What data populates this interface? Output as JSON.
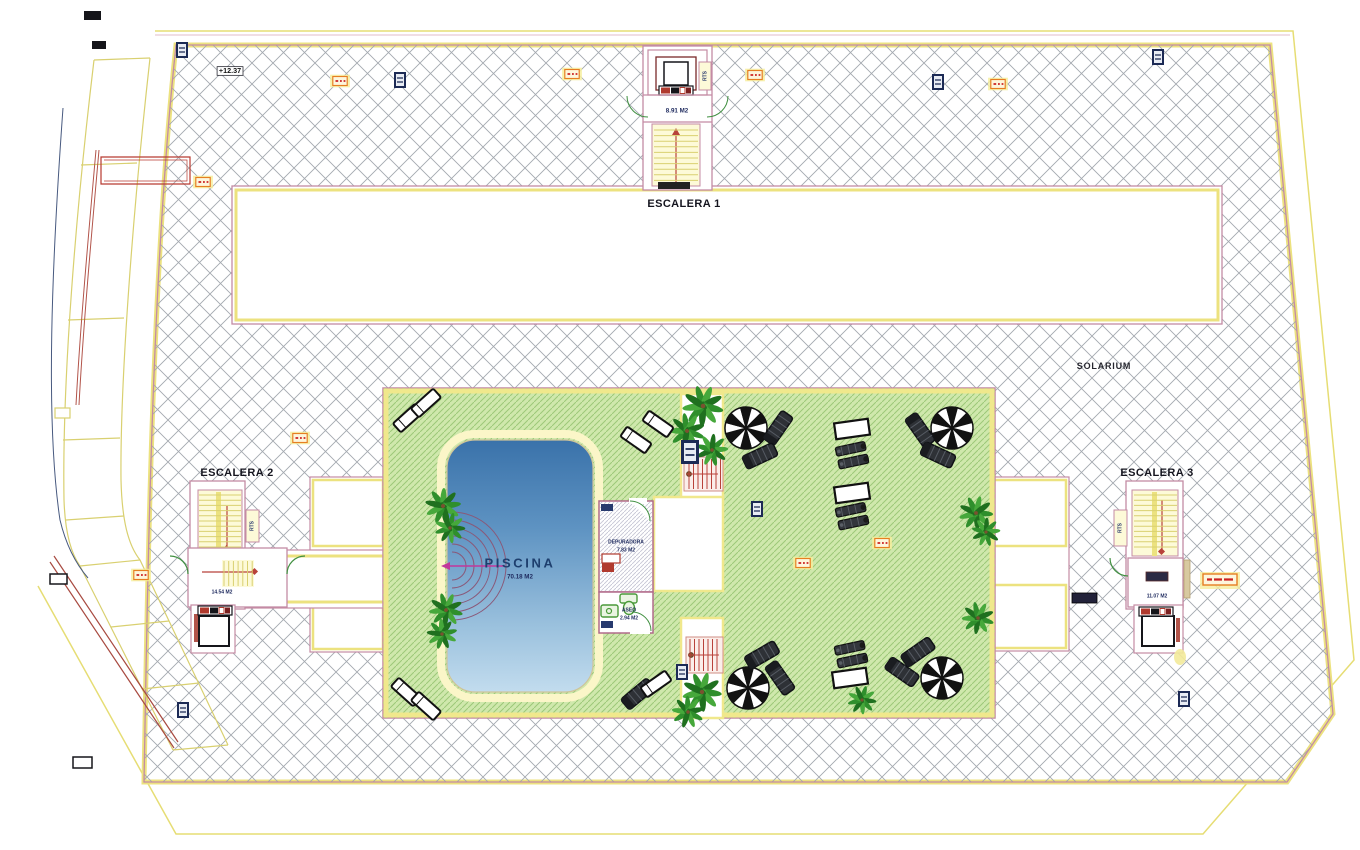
{
  "labels": {
    "escalera1": "ESCALERA 1",
    "escalera2": "ESCALERA 2",
    "escalera3": "ESCALERA 3",
    "solarium": "SOLARIUM",
    "elevation": "+12.37",
    "rts": "RTS",
    "escalera1_area": "8.91 M2",
    "escalera2_area": "14.54 M2",
    "escalera3_area": "11.07 M2",
    "piscina": "PISCINA",
    "piscina_area": "70.18 M2",
    "depuradora": "DEPURADORA",
    "depuradora_area": "7.83 M2",
    "aseo": "ASEO",
    "aseo_area": "2.94 M2"
  },
  "colors": {
    "wall_pink": "#c48ba4",
    "band_yellow": "#ece27f",
    "hatch_gray": "#a3a8af",
    "green_fill": "#cfe8ac",
    "green_hatch": "#9cc878",
    "pool_top": "#3a72aa",
    "pool_bottom": "#c2dcee",
    "stair_red": "#b8423a",
    "accent_maroon": "#b2544a",
    "marker_navy": "#1c2a55",
    "marker_orange": "#e67e22"
  },
  "plan_items": {
    "palms": [
      [
        703,
        406,
        1.15
      ],
      [
        687,
        431,
        1.0
      ],
      [
        712,
        450,
        0.9
      ],
      [
        443,
        506,
        1.0
      ],
      [
        450,
        528,
        0.85
      ],
      [
        446,
        610,
        0.95
      ],
      [
        442,
        634,
        0.85
      ],
      [
        976,
        513,
        0.95
      ],
      [
        986,
        532,
        0.8
      ],
      [
        978,
        618,
        0.9
      ],
      [
        702,
        692,
        1.1
      ],
      [
        688,
        712,
        0.9
      ],
      [
        862,
        700,
        0.8
      ]
    ],
    "parasols": [
      [
        746,
        428
      ],
      [
        952,
        428
      ],
      [
        748,
        688
      ],
      [
        942,
        678
      ]
    ],
    "loungers_dark": [
      [
        778,
        428,
        -55
      ],
      [
        760,
        456,
        -25
      ],
      [
        920,
        430,
        55
      ],
      [
        938,
        455,
        25
      ],
      [
        762,
        655,
        -30
      ],
      [
        780,
        678,
        55
      ],
      [
        638,
        694,
        -40
      ],
      [
        918,
        652,
        -35
      ],
      [
        902,
        672,
        35
      ]
    ],
    "loungers_white": [
      [
        408,
        418,
        -42
      ],
      [
        426,
        403,
        -42
      ],
      [
        406,
        692,
        42
      ],
      [
        426,
        706,
        42
      ],
      [
        656,
        684,
        -35
      ],
      [
        658,
        424,
        35
      ],
      [
        636,
        440,
        35
      ]
    ],
    "lounger_pairs": [
      [
        853,
        455,
        -12
      ],
      [
        853,
        516,
        -12
      ],
      [
        852,
        654,
        -12
      ]
    ],
    "tables": [
      [
        852,
        429,
        -8
      ],
      [
        852,
        493,
        -8
      ],
      [
        850,
        678,
        -8
      ]
    ],
    "markers_navy": [
      [
        400,
        80,
        1
      ],
      [
        938,
        82,
        1
      ],
      [
        1158,
        57,
        1
      ],
      [
        182,
        50,
        1
      ],
      [
        183,
        710,
        1
      ],
      [
        1184,
        699,
        1
      ],
      [
        682,
        672,
        1
      ],
      [
        757,
        509,
        1
      ],
      [
        690,
        452,
        1.5
      ]
    ],
    "markers_orange": [
      [
        340,
        81
      ],
      [
        572,
        74
      ],
      [
        755,
        75
      ],
      [
        998,
        84
      ],
      [
        203,
        182
      ],
      [
        300,
        438
      ],
      [
        141,
        575
      ],
      [
        803,
        563
      ],
      [
        882,
        543
      ]
    ]
  }
}
